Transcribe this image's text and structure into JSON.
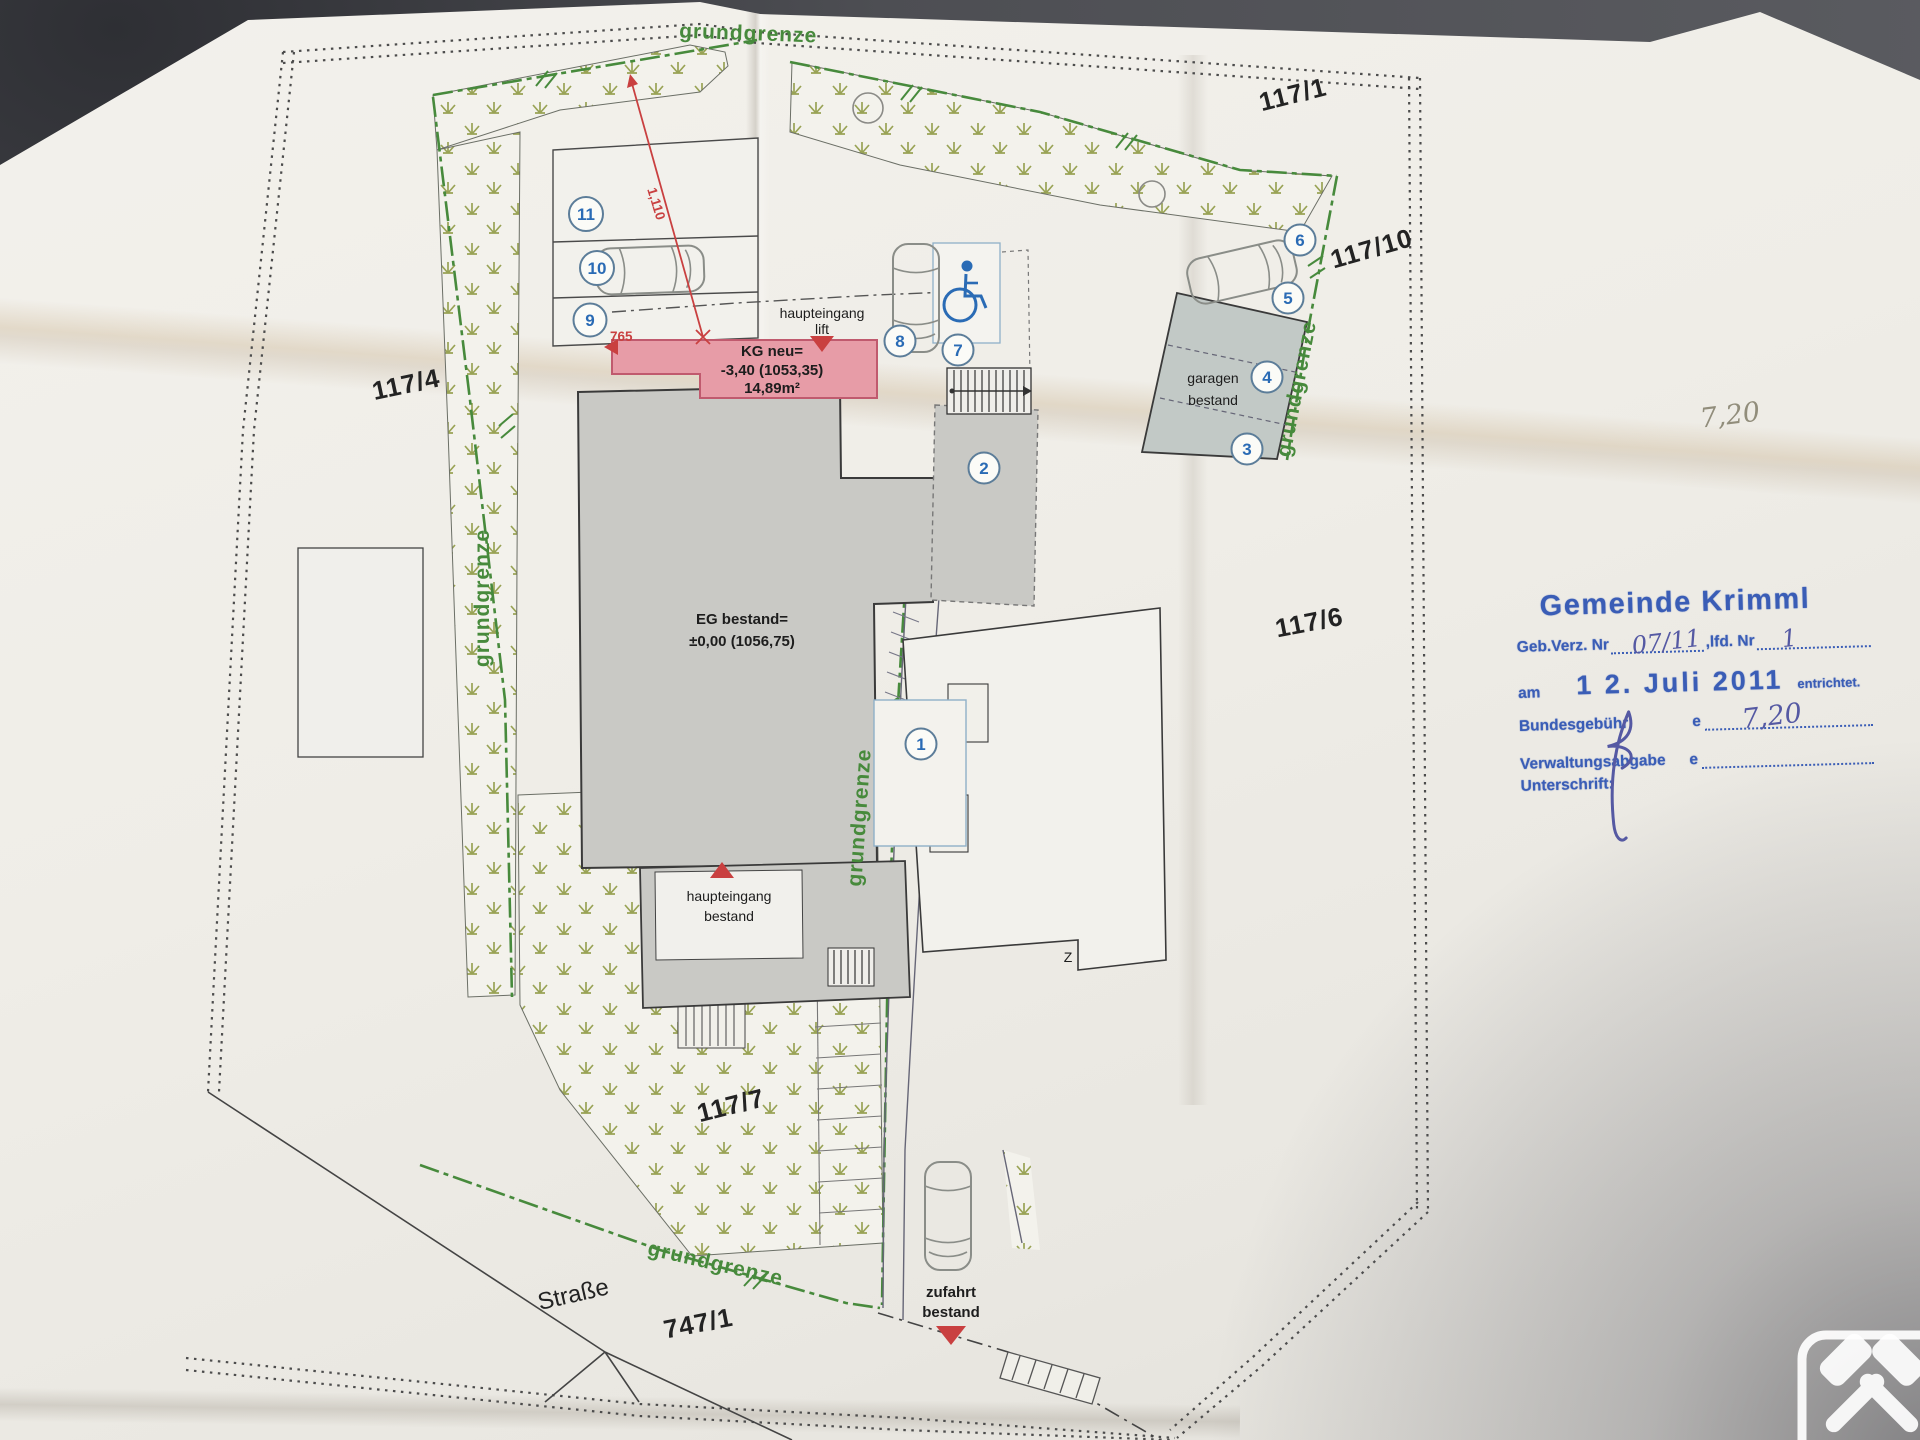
{
  "plan": {
    "boundary_label": "grundgrenze",
    "parcels": {
      "p117_1": "117/1",
      "p117_10": "117/10",
      "p117_4": "117/4",
      "p117_6": "117/6",
      "p117_7": "117/7",
      "p747_1": "747/1"
    },
    "street_label": "Straße",
    "z_mark": "Z",
    "buildings": {
      "eg_line1": "EG bestand=",
      "eg_line2": "±0,00 (1056,75)",
      "kg_line1": "KG neu=",
      "kg_line2": "-3,40 (1053,35)",
      "kg_line3": "14,89m²",
      "garage_line1": "garagen",
      "garage_line2": "bestand"
    },
    "entrances": {
      "lift_line1": "haupteingang",
      "lift_line2": "lift",
      "main_line1": "haupteingang",
      "main_line2": "bestand",
      "drive_line1": "zufahrt",
      "drive_line2": "bestand"
    },
    "parking_numbers": [
      "1",
      "2",
      "3",
      "4",
      "5",
      "6",
      "7",
      "8",
      "9",
      "10",
      "11"
    ],
    "measurements": {
      "diagonal": "1,110",
      "offset": "765"
    }
  },
  "stamp": {
    "title": "Gemeinde Krimml",
    "row1_label": "Geb.Verz. Nr",
    "row1_value": "07/11",
    "row1_label2": ",lfd. Nr",
    "row1_value2": "1",
    "row2_label": "am",
    "row2_date": "1 2. Juli 2011",
    "row2_suffix": "entrichtet.",
    "row3_label": "Bundesgebühr",
    "row3_currency": "e",
    "row3_value": "7,20",
    "row4_label": "Verwaltungsabgabe",
    "row4_currency": "e",
    "row5_label": "Unterschrift:"
  },
  "annotations": {
    "pencil_note": "7,20"
  },
  "colors": {
    "stamp_blue": "#2d53b3",
    "handwriting_blue": "#4a4f9f",
    "boundary_green": "#478a3c",
    "kg_pink": "#e79ca7",
    "building_gray": "#c9c9c5",
    "garage_gray": "#c2c9c6",
    "marker_red": "#c94040",
    "number_blue": "#2a6bb5",
    "pencil_gray": "#918d7b"
  }
}
